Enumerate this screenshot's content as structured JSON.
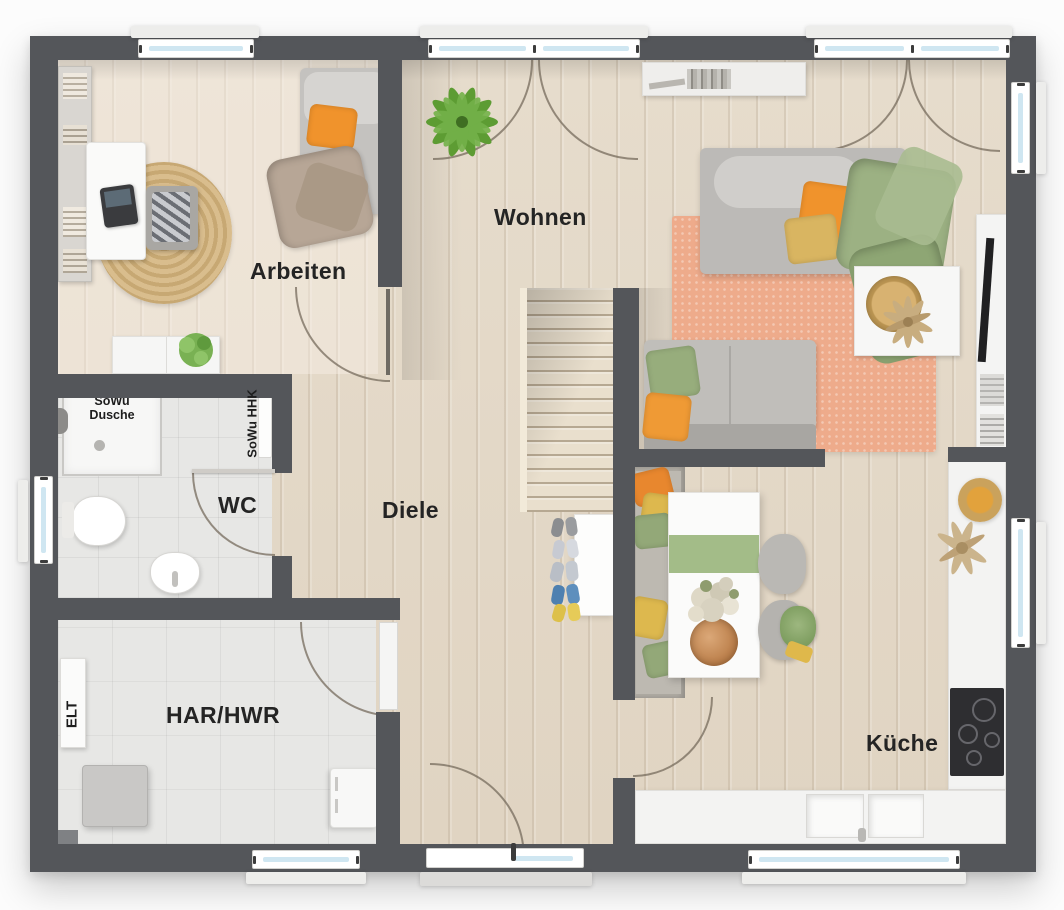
{
  "page": {
    "background": "#fcfcfc",
    "type": "architectural floor plan, top-down 3D render"
  },
  "rooms": {
    "arbeiten": {
      "label": "Arbeiten"
    },
    "wohnen": {
      "label": "Wohnen"
    },
    "wc": {
      "label": "WC"
    },
    "diele": {
      "label": "Diele"
    },
    "har_hwr": {
      "label": "HAR/HWR"
    },
    "kueche": {
      "label": "Küche"
    }
  },
  "annotations": {
    "shower_line1": "SoWu",
    "shower_line2": "Dusche",
    "radiator": "SoWu HHK",
    "electrical": "ELT"
  },
  "palette": {
    "wall_gray": "#54565a",
    "wood_floor": "#e3d8c7",
    "tile_floor": "#e7e7e5",
    "window_glass": "#cfe6f1",
    "accent_orange": "#f0932c",
    "accent_yellow": "#d9b561",
    "accent_green": "#94ab79",
    "rug_salmon": "#eeab8b",
    "counter_white": "#f3f3f2",
    "sofa_gray": "#bcbab7",
    "cooktop_black": "#2e2e31"
  }
}
